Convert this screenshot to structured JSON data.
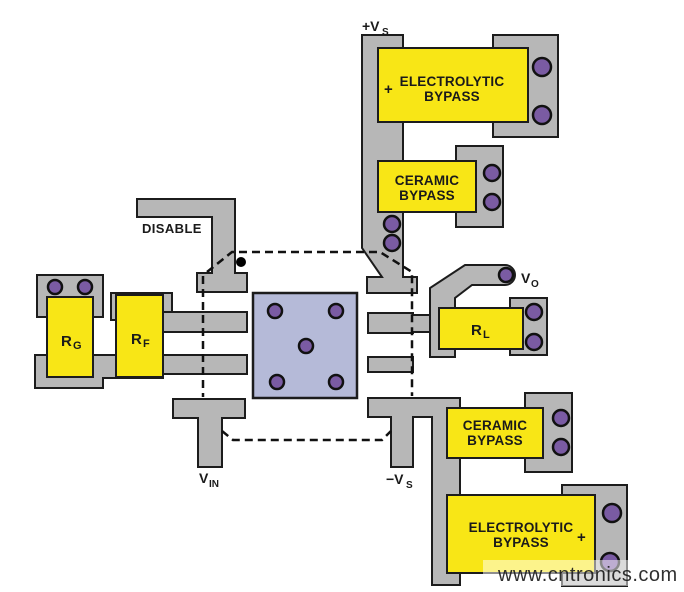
{
  "colors": {
    "trace_gray": "#b7b7b7",
    "component_yellow": "#f8e616",
    "via_purple": "#7a5ba3",
    "ic_body_blue": "#b5bad8",
    "outline_black": "#1c1c1c",
    "watermark_green": "#9cd596",
    "background": "#ffffff"
  },
  "labels": {
    "supply_positive": {
      "main": "+V",
      "sub": "S"
    },
    "supply_negative": {
      "main": "−V",
      "sub": "S"
    },
    "input": {
      "main": "V",
      "sub": "IN"
    },
    "output": {
      "main": "V",
      "sub": "O"
    },
    "gain_resistor": {
      "main": "R",
      "sub": "G"
    },
    "feedback_resistor": {
      "main": "R",
      "sub": "F"
    },
    "load_resistor": {
      "main": "R",
      "sub": "L"
    },
    "disable": "DISABLE"
  },
  "capacitors": {
    "top_electrolytic": {
      "line1": "ELECTROLYTIC",
      "line2": "BYPASS",
      "polarity": "+"
    },
    "top_ceramic": {
      "line1": "CERAMIC",
      "line2": "BYPASS"
    },
    "bottom_ceramic": {
      "line1": "CERAMIC",
      "line2": "BYPASS"
    },
    "bottom_electrolytic": {
      "line1": "ELECTROLYTIC",
      "line2": "BYPASS",
      "polarity": "+"
    }
  },
  "watermark": {
    "text": "www.cntronics.com"
  }
}
